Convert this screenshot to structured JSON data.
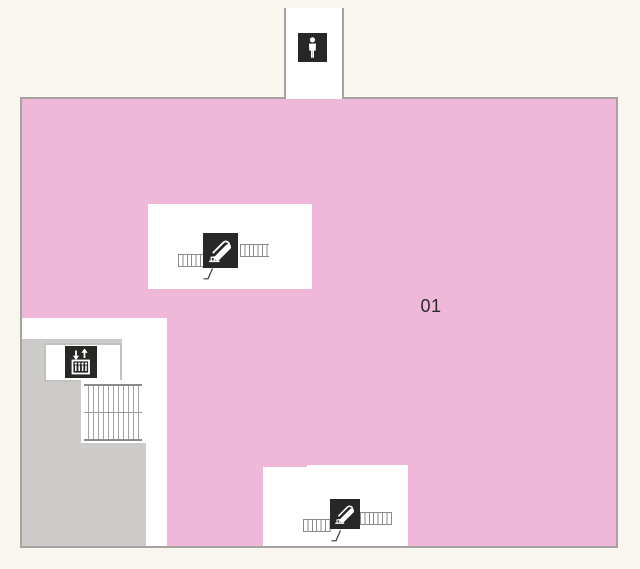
{
  "map": {
    "area_label": "01",
    "areas": [
      {
        "name": "floor-area-01",
        "label": "01",
        "fill": "#f0b8d8"
      },
      {
        "name": "service-core",
        "label": "",
        "fill": "#cccbc9"
      },
      {
        "name": "restroom-annex",
        "label": "",
        "fill": "#ffffff"
      }
    ],
    "icons": [
      "mens-restroom-icon",
      "escalator-icon-upper",
      "escalator-icon-lower",
      "elevator-icon",
      "stairs-symbol"
    ],
    "colors": {
      "background": "#f8f6ef",
      "floor_fill": "#f0b8d8",
      "floor_border": "#a4a3a0",
      "service_gray": "#cccbc9",
      "symbol_tile_bg": "#272725",
      "symbol_glyph": "#ffffff",
      "steps_stroke": "#8a8a88"
    }
  }
}
